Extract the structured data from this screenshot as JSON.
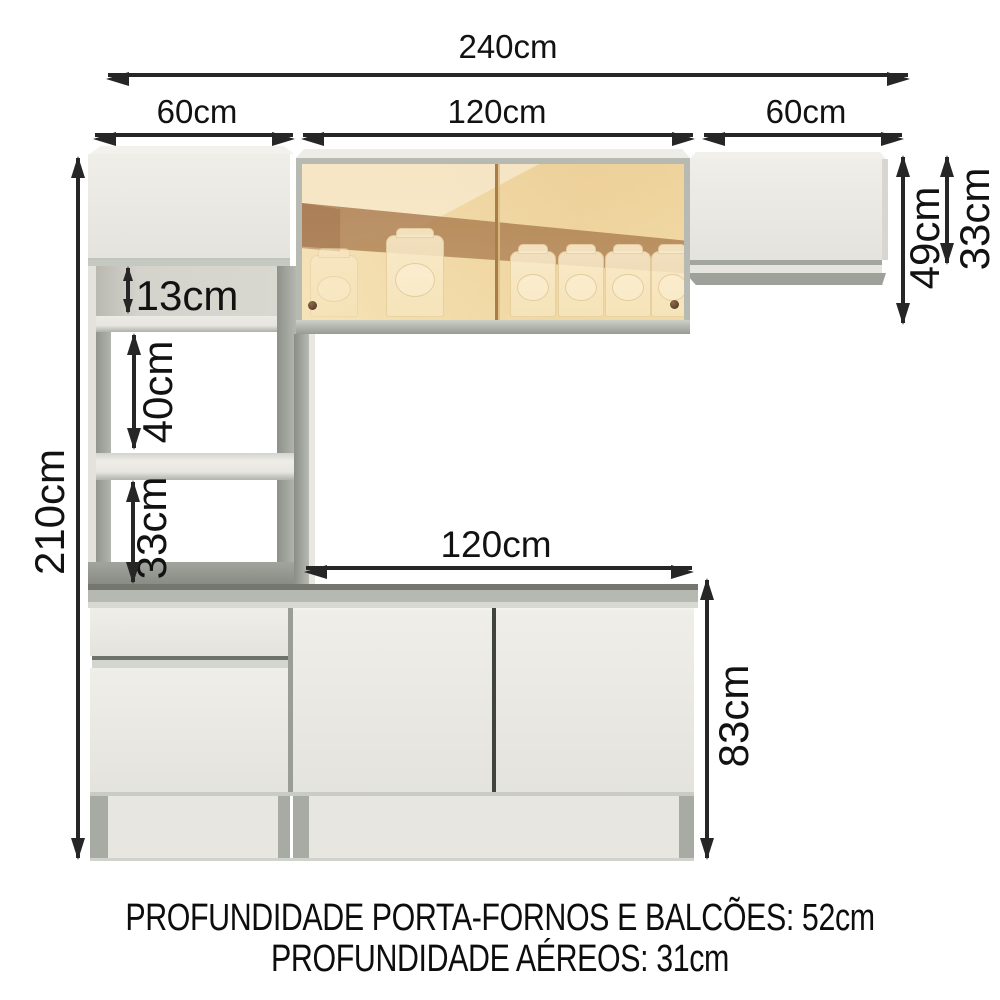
{
  "diagram": {
    "title": "kitchen-cabinet-dimensions",
    "labels": {
      "total_width": "240cm",
      "left_column_width": "60cm",
      "center_width": "120cm",
      "right_column_width": "60cm",
      "total_height": "210cm",
      "glass_cabinet_height": "49cm",
      "right_aerial_height": "33cm",
      "top_niche_height": "13cm",
      "oven_niche_height": "40cm",
      "lower_niche_height": "33cm",
      "counter_width": "120cm",
      "base_height": "83cm"
    },
    "footer": {
      "line1": "PROFUNDIDADE PORTA-FORNOS E BALCÕES: 52cm",
      "line2": "PROFUNDIDADE AÉREOS: 31cm"
    },
    "colors": {
      "cabinet_white": "#eae9e3",
      "panel_gray": "#a0a29c",
      "counter_gray": "#b6b8b2",
      "glass_amber": "#f0d9a6",
      "glass_brown": "#99683f",
      "arrow_black": "#262626"
    }
  }
}
